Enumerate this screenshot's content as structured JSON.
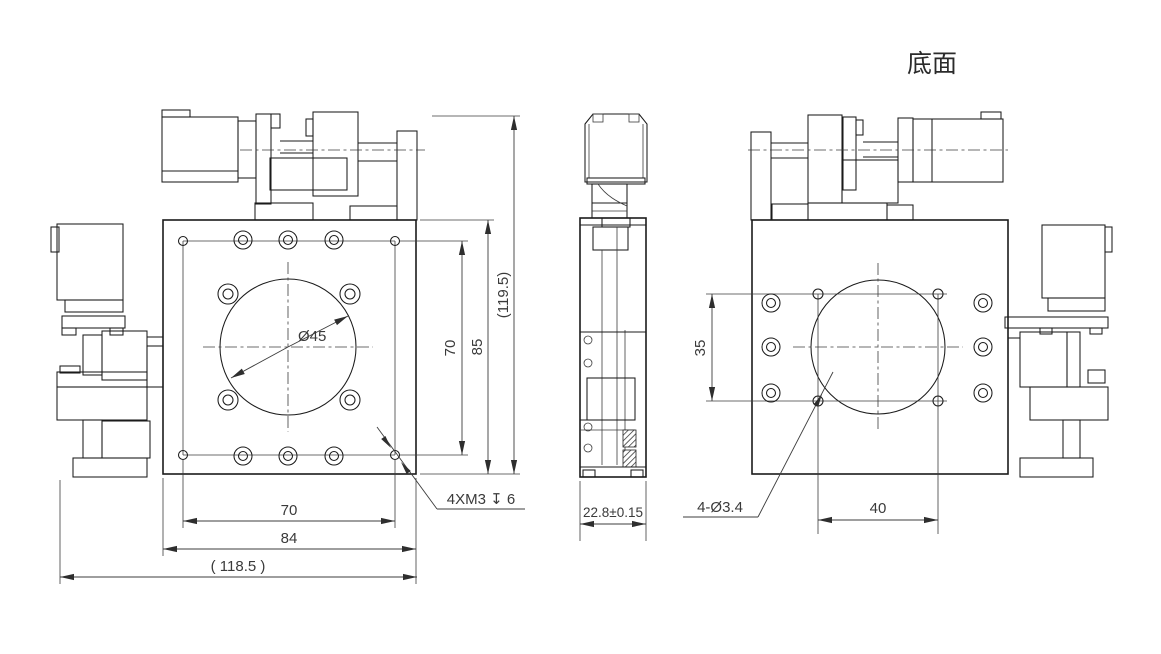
{
  "front_view": {
    "circle_dia_label": "Ø45",
    "thread_callout": "4XM3 ↧ 6",
    "dim_holes_vertical": "70",
    "dim_plate_height": "85",
    "dim_overall_height": "(119.5)",
    "dim_holes_horizontal": "70",
    "dim_plate_width": "84",
    "dim_overall_width": "( 118.5 )"
  },
  "side_view": {
    "dim_thickness": "22.8±0.15"
  },
  "bottom_view": {
    "label": "底面",
    "hole_callout": "4-Ø3.4",
    "dim_hole_spacing_v": "35",
    "dim_hole_spacing_h": "40"
  }
}
